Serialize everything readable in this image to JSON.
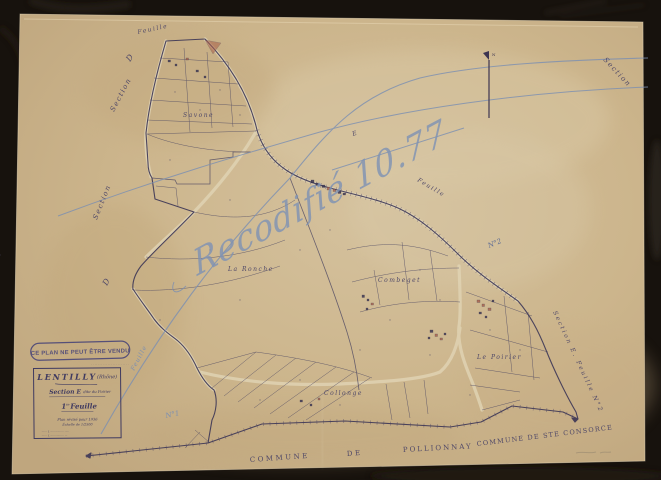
{
  "stamp": {
    "text": "CE PLAN NE PEUT ÊTRE VENDU"
  },
  "cartouche": {
    "commune": "LENTILLY",
    "departement": "(Rhône)",
    "section_prefix": "Section E",
    "section_suffix": "dite du Poirier",
    "sheet_number": "1",
    "sheet_sup": "re",
    "sheet_word": "Feuille",
    "revision_line": "Plan révisé pour 1936",
    "scale_line": "Échelle de 1/2500",
    "margin_note": "· · · · · · · · · · · · · · · · · · · · · · ·",
    "fine_print_1": "······ { ··············· ·····",
    "fine_print_2": "······ { ··············· ···"
  },
  "map_labels": {
    "feuille_top": "Feuille",
    "section_upper_left": "Section",
    "d_upper": "D",
    "section_lower_left": "Section",
    "d_lower": "D",
    "section_top_right": "Section",
    "e_marker": "E",
    "feuille_right": "Feuille",
    "feuille_blue": "Feuille",
    "edge_label": "Section E. Feuille N°2",
    "n1": "N°1",
    "n2": "N°2",
    "place_savone": "Savone",
    "place_la_ronche": "La Ronche",
    "place_combeget": "Combeget",
    "place_collonge": "Collonge",
    "place_le_poirier": "Le Poirier",
    "commune_word": "COMMUNE",
    "de_word": "DE",
    "pollionnay": "POLLIONNAY",
    "ste_consorce": "COMMUNE DE STE CONSORCE"
  },
  "annotations": {
    "cursive": "Recodifié 10.77",
    "north": "N"
  },
  "colors": {
    "background": "#17120d",
    "paper": "#cdb890",
    "ink": "#45405f",
    "pencil_blue": "#7b8fb2",
    "stamp_ink": "#4a4678",
    "building_red": "#a85f48"
  }
}
